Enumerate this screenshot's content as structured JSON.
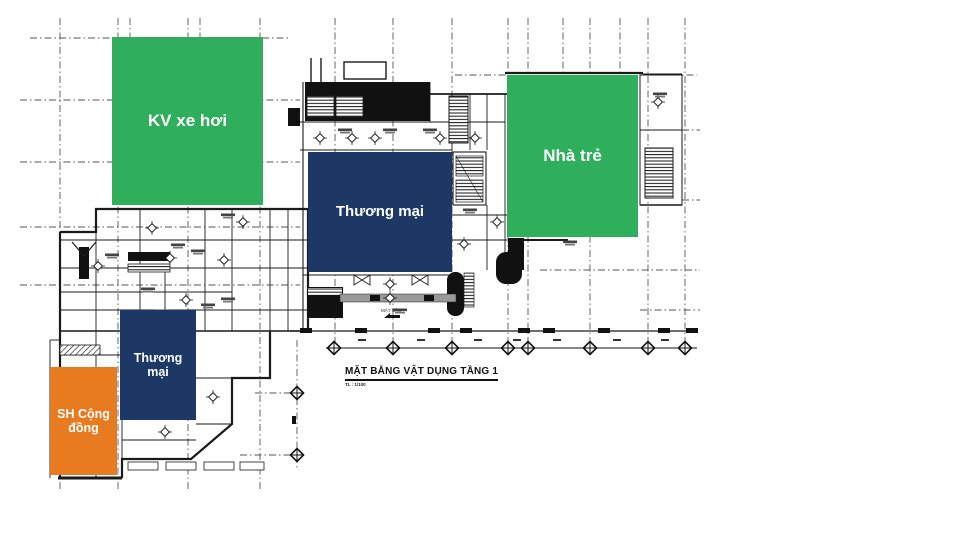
{
  "title": {
    "text": "MẶT BẰNG VẬT DỤNG TẦNG 1",
    "scale_note": "TL : 1/100"
  },
  "zones": {
    "kv_xe_hoi": {
      "label": "KV xe hơi",
      "color": "#2fae5b"
    },
    "nha_tre": {
      "label": "Nhà trẻ",
      "color": "#2fae5b"
    },
    "thuong_mai_lon": {
      "label": "Thương mại",
      "color": "#1d3865"
    },
    "thuong_mai_nho": {
      "label": "Thương mại",
      "color": "#1d3865"
    },
    "sh_cong_dong": {
      "label": "SH Cộng đồng",
      "color": "#e87b20"
    }
  },
  "annotations": {
    "ground_level": "MẶT SÂN"
  },
  "palette": {
    "green": "#2fae5b",
    "navy": "#1d3865",
    "orange": "#e87b20",
    "wall_line": "#1a1a1a",
    "grid_line": "#555555"
  }
}
